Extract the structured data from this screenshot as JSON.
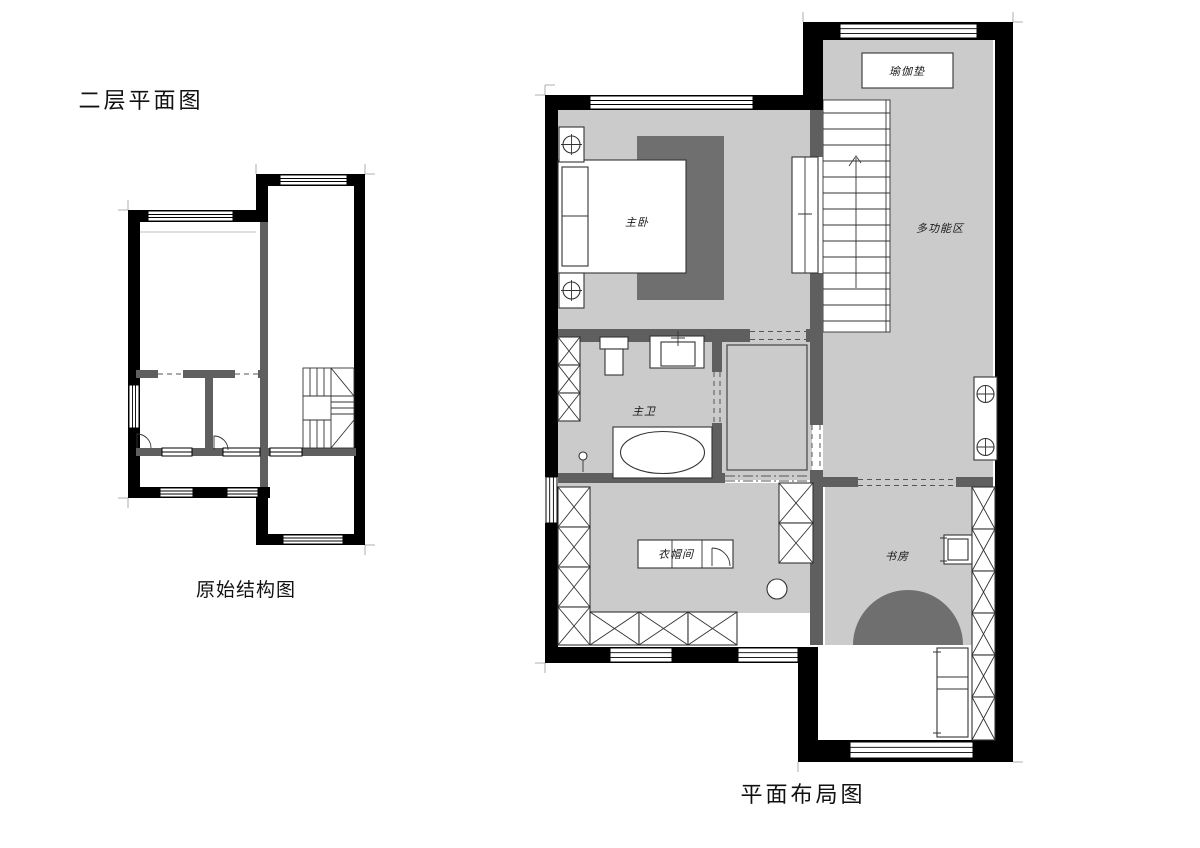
{
  "titles": {
    "floor_title": "二层平面图",
    "small_plan_caption": "原始结构图",
    "large_plan_caption": "平面布局图"
  },
  "large_plan": {
    "rooms": {
      "yoga_mat": "瑜伽垫",
      "master_bedroom": "主卧",
      "multi_function_zone": "多功能区",
      "master_bathroom": "主卫",
      "cloakroom": "衣帽间",
      "study": "书房"
    }
  },
  "colors": {
    "outer_wall": "#000000",
    "partition_wall": "#5f5f5f",
    "floor_fill": "#cbcbcb",
    "rug_fill": "#6f6f6f",
    "background": "#ffffff"
  }
}
